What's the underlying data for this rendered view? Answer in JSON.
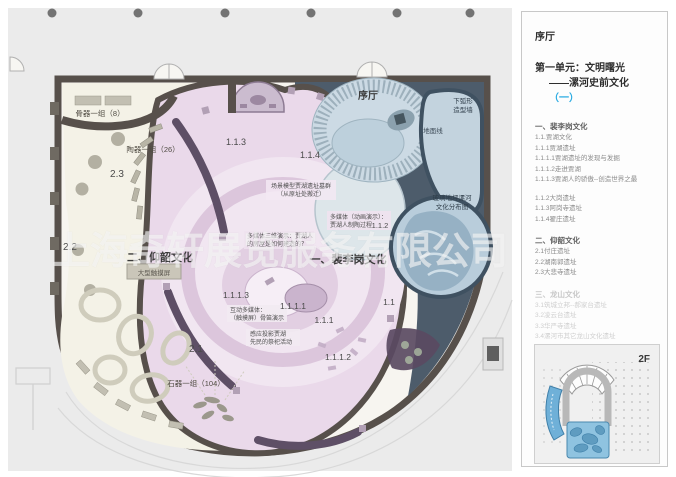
{
  "panel": {
    "hall_label": "序厅",
    "unit_line1": "第一单元：文明曙光",
    "unit_line2": "——漯河史前文化",
    "unit_suffix": "（一）",
    "accent_color": "#29abe2",
    "floor_label": "2F",
    "sections": [
      {
        "heading": "一、裴李岗文化",
        "groups": [
          [
            "1.1.贾湖文化",
            "1.1.1贾湖遗址",
            "1.1.1.1贾湖遗址的发现与发掘",
            "1.1.1.2走进贾湖",
            "1.1.1.3贾湖人的骄傲--创造世界之最"
          ],
          [
            "1.1.2大岗遗址",
            "1.1.3阿岗寺遗址",
            "1.1.4翟庄遗址"
          ]
        ]
      },
      {
        "heading": "二、仰韶文化",
        "groups": [
          [
            "2.1付庄遗址",
            "2.2湖南郭遗址",
            "2.3大悲寺遗址"
          ]
        ]
      },
      {
        "heading": "三、龙山文化",
        "groups": [
          [
            "3.1筑城立邦--郝家台遗址",
            "3.2凌云台遗址",
            "3.3华严寺遗址",
            "3.4漯河市其它龙山文化遗址"
          ]
        ]
      }
    ]
  },
  "plan": {
    "watermark": "上海奇轩展览服务有限公司",
    "zone_titles": {
      "unit1": "一、裴李岗文化",
      "unit2": "二、仰韶文化",
      "hall": "序厅"
    },
    "labels": {
      "bone_group": "骨器一组（8）",
      "pottery_group": "陶器一组（26）",
      "stone_group": "石器一组（104）",
      "touch_screen": "大型触摸屏",
      "scene_model_1": "场景模型贾湖遗址墓群",
      "scene_model_2": "（从原址处搬迁）",
      "media_anim_1": "多媒体（动画演示）：",
      "media_anim_2": "贾湖人制陶过程",
      "media_3d_1": "多媒体三维演示：贾湖人",
      "media_3d_2": "的房屋是如何建造的？",
      "interact_1": "互动多媒体：",
      "interact_2": "（触摸屏）骨笛演示",
      "projection_1": "感应投影贾湖",
      "projection_2": "先民的祭祀活动",
      "arc_wall_1": "下弧形",
      "arc_wall_2": "造型墙",
      "ground_line": "地面线",
      "glass_floor_1": "玻璃地坪漯河",
      "glass_floor_2": "文化分布图"
    },
    "numbers": {
      "n1_1": "1.1",
      "n1_1_1": "1.1.1",
      "n1_1_1_1": "1.1.1.1",
      "n1_1_1_2": "1.1.1.2",
      "n1_1_1_3": "1.1.1.3",
      "n1_1_2": "1.1.2",
      "n1_1_3": "1.1.3",
      "n1_1_4": "1.1.4",
      "n2_1": "2.1",
      "n2_2": "2.2",
      "n2_3": "2.3"
    },
    "colors": {
      "wall": "#57504b",
      "navy": "#4d5c6b",
      "pink_zone": "#ead9ea",
      "cream_zone": "#f4f2e7",
      "hall_blue": "#ccdae4",
      "glass_blue": "#b9cddb",
      "accent_cyan": "#29abe2"
    }
  }
}
